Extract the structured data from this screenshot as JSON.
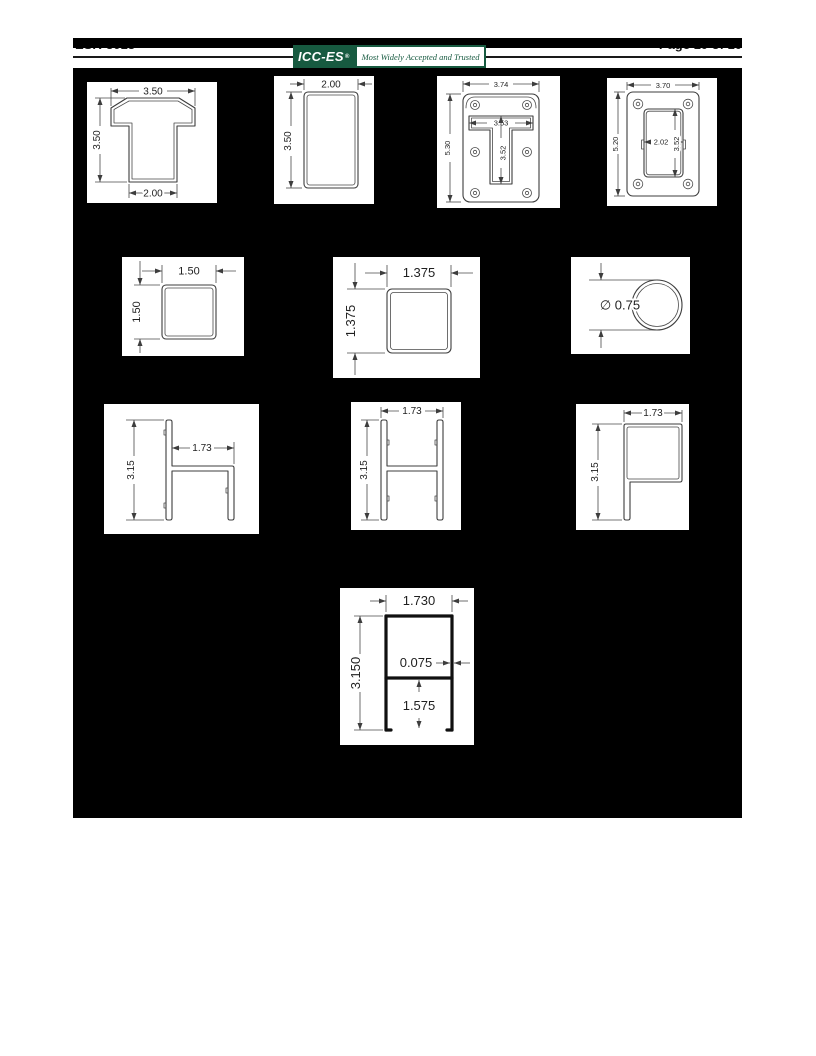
{
  "header": {
    "doc_number": "ESR-3013",
    "page_label": "Page 10 of 10",
    "logo": {
      "name": "ICC-ES",
      "registered": "®",
      "tagline": "Most Widely Accepted and Trusted",
      "green": "#175a40"
    }
  },
  "figures": [
    {
      "label": "t-shaped post cap",
      "width": "3.50",
      "height": "3.50",
      "base": "2.00"
    },
    {
      "label": "rectangular tube",
      "width": "2.00",
      "height": "3.50"
    },
    {
      "label": "mounting bracket",
      "width": "3.74",
      "height": "5.30",
      "slot_width": "3.53",
      "slot_height": "3.52"
    },
    {
      "label": "mounting plate",
      "width": "3.70",
      "height": "5.20",
      "opening_width": "2.02",
      "opening_height": "3.52"
    },
    {
      "label": "square tube",
      "width": "1.50",
      "height": "1.50"
    },
    {
      "label": "square tube small",
      "width": "1.375",
      "height": "1.375"
    },
    {
      "label": "round tube",
      "diameter": "∅ 0.75"
    },
    {
      "label": "h channel",
      "width": "1.73",
      "height": "3.15"
    },
    {
      "label": "double channel",
      "width": "1.73",
      "height": "3.15"
    },
    {
      "label": "p channel",
      "width": "1.73",
      "height": "3.15"
    },
    {
      "label": "bottom rail",
      "width": "1.730",
      "height": "3.150",
      "wall": "0.075",
      "leg": "1.575"
    }
  ]
}
